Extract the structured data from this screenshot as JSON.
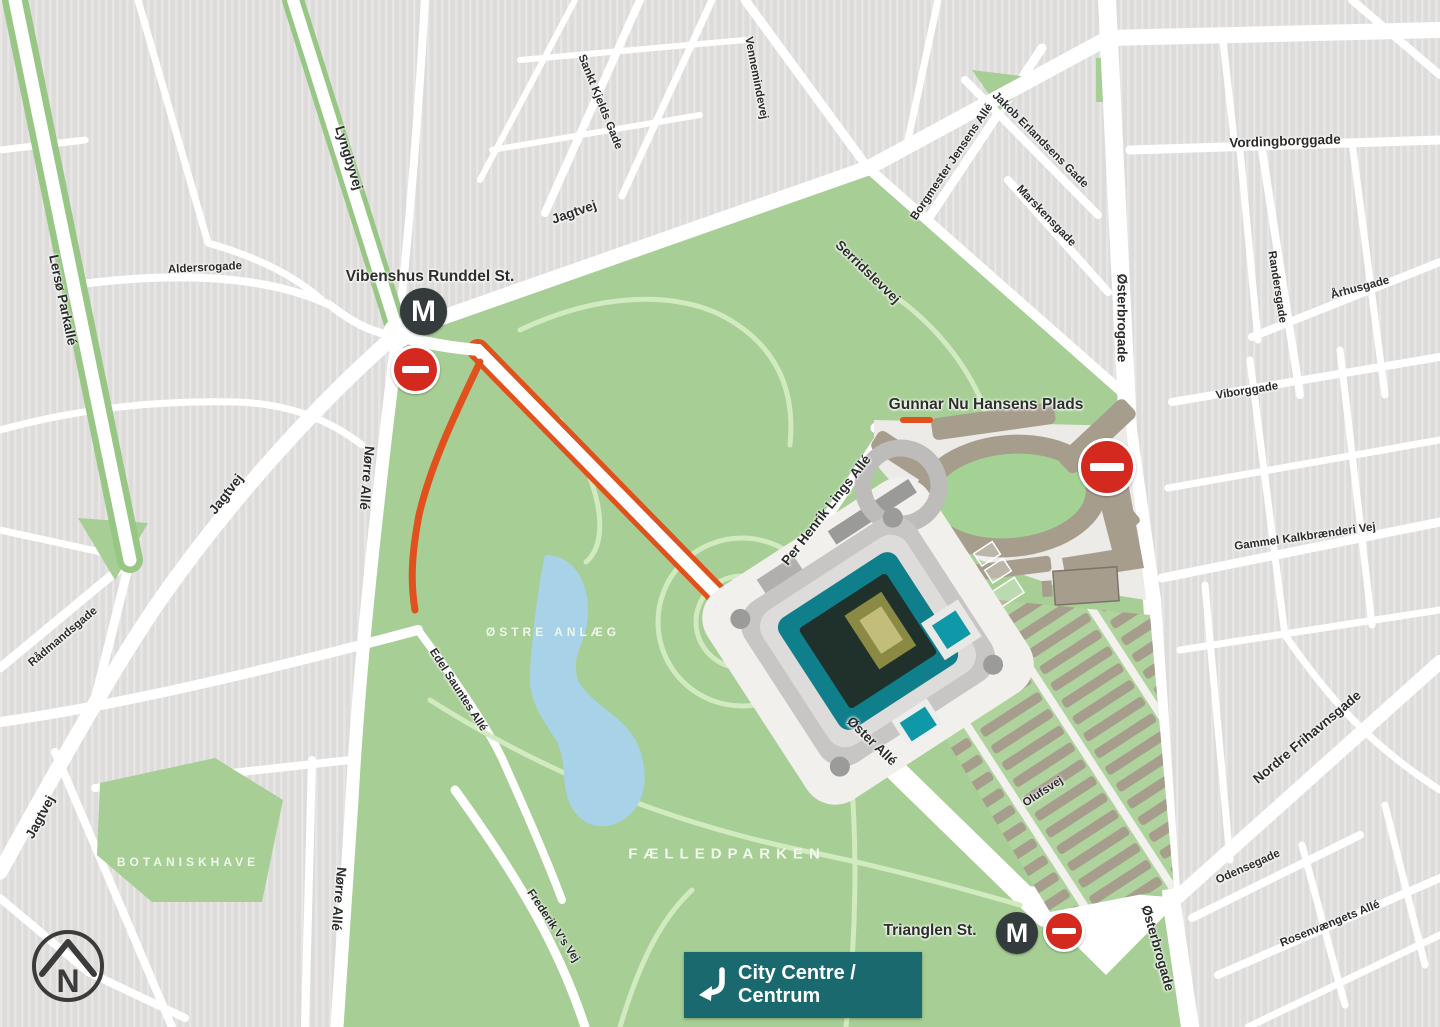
{
  "map": {
    "icons": {
      "metro_label": "M",
      "compass_label": "N",
      "no_entry_icon": "no-entry-sign",
      "metro_icon": "metro-station-circle",
      "compass_icon": "north-arrow-compass",
      "route_icon": "orange-route-highlight"
    },
    "city_centre": {
      "line1": "City Centre /",
      "line2": "Centrum",
      "arrow_icon": "bent-arrow-down-left"
    },
    "colors": {
      "park_green": "#a6ce95",
      "park_light": "#b2d6a0",
      "path_green": "#d2eabf",
      "block_gray": "#dddcda",
      "block_stripe": "#e7e6e4",
      "road_white": "#ffffff",
      "plaza_gray": "#ecebe8",
      "lake_blue": "#a8d2e8",
      "route_orange": "#e0511d",
      "metro_dark": "#333b3c",
      "no_entry_red": "#d4291f",
      "stand_tan": "#a69d8d",
      "teal_box": "#19696e",
      "stadium_teal": "#0f7f8b",
      "field_dark": "#20302a"
    },
    "labels": [
      {
        "id": "lerso-parkalle",
        "text": "Lersø Parkallé",
        "x": 63,
        "y": 300,
        "rot": 78,
        "cls": "street"
      },
      {
        "id": "lyngbyvej",
        "text": "Lyngbyvej",
        "x": 349,
        "y": 158,
        "rot": 73,
        "cls": "street"
      },
      {
        "id": "aldersrogade",
        "text": "Aldersrogade",
        "x": 205,
        "y": 268,
        "rot": -3,
        "cls": "street-sm"
      },
      {
        "id": "jagtvej-top",
        "text": "Jagtvej",
        "x": 574,
        "y": 212,
        "rot": -19,
        "cls": "street"
      },
      {
        "id": "sankt-kjelds-gade",
        "text": "Sankt Kjelds Gade",
        "x": 600,
        "y": 102,
        "rot": 68,
        "cls": "street-sm"
      },
      {
        "id": "vennemindevej",
        "text": "Vennemindevej",
        "x": 756,
        "y": 78,
        "rot": 79,
        "cls": "street-sm"
      },
      {
        "id": "serridslevvej",
        "text": "Serridslevvej",
        "x": 868,
        "y": 272,
        "rot": 44,
        "cls": "street"
      },
      {
        "id": "borgmester-jensens-alle",
        "text": "Borgmester Jensens Allé",
        "x": 952,
        "y": 162,
        "rot": -56,
        "cls": "street-sm"
      },
      {
        "id": "jakob-erlandsens-gade",
        "text": "Jakob Erlandsens Gade",
        "x": 1040,
        "y": 140,
        "rot": 45,
        "cls": "street-sm"
      },
      {
        "id": "marskensgade",
        "text": "Marskensgade",
        "x": 1046,
        "y": 216,
        "rot": 46,
        "cls": "street-sm"
      },
      {
        "id": "vordingborggade",
        "text": "Vordingborggade",
        "x": 1285,
        "y": 141,
        "rot": -2,
        "cls": "street"
      },
      {
        "id": "osterbrogade-top",
        "text": "Østerbrogade",
        "x": 1122,
        "y": 318,
        "rot": 90,
        "cls": "street"
      },
      {
        "id": "randersgade",
        "text": "Randersgade",
        "x": 1277,
        "y": 287,
        "rot": 81,
        "cls": "street-sm"
      },
      {
        "id": "aarhusgade",
        "text": "Århusgade",
        "x": 1360,
        "y": 288,
        "rot": -15,
        "cls": "street-sm"
      },
      {
        "id": "viborggade",
        "text": "Viborggade",
        "x": 1247,
        "y": 391,
        "rot": -9,
        "cls": "street-sm"
      },
      {
        "id": "gammel-kalkbraenderi-vej",
        "text": "Gammel Kalkbrænderi Vej",
        "x": 1305,
        "y": 537,
        "rot": -8,
        "cls": "street-sm"
      },
      {
        "id": "nordre-frihavnsgade",
        "text": "Nordre Frihavnsgade",
        "x": 1307,
        "y": 737,
        "rot": -40,
        "cls": "street"
      },
      {
        "id": "osterbrogade-bottom",
        "text": "Østerbrogade",
        "x": 1158,
        "y": 948,
        "rot": 74,
        "cls": "street"
      },
      {
        "id": "odensegade",
        "text": "Odensegade",
        "x": 1248,
        "y": 867,
        "rot": -24,
        "cls": "street-sm"
      },
      {
        "id": "rosenvaengets-alle",
        "text": "Rosenvængets Allé",
        "x": 1330,
        "y": 924,
        "rot": -22,
        "cls": "street-sm"
      },
      {
        "id": "gunnar-nu-hansens-plads",
        "text": "Gunnar Nu Hansens Plads",
        "x": 986,
        "y": 405,
        "rot": 0,
        "cls": "station"
      },
      {
        "id": "per-henrik-lings-alle",
        "text": "Per Henrik Lings Allé",
        "x": 826,
        "y": 510,
        "rot": -52,
        "cls": "street"
      },
      {
        "id": "oster-alle",
        "text": "Øster Allé",
        "x": 872,
        "y": 741,
        "rot": 44,
        "cls": "street"
      },
      {
        "id": "olufsvej",
        "text": "Olufsvej",
        "x": 1043,
        "y": 792,
        "rot": -33,
        "cls": "street-sm"
      },
      {
        "id": "norre-alle-upper",
        "text": "Nørre Allé",
        "x": 367,
        "y": 478,
        "rot": 95,
        "cls": "street"
      },
      {
        "id": "norre-alle-lower",
        "text": "Nørre Allé",
        "x": 339,
        "y": 899,
        "rot": 95,
        "cls": "street"
      },
      {
        "id": "jagtvej-left",
        "text": "Jagtvej",
        "x": 226,
        "y": 494,
        "rot": -52,
        "cls": "street"
      },
      {
        "id": "jagtvej-bottom-left",
        "text": "Jagtvej",
        "x": 40,
        "y": 817,
        "rot": -62,
        "cls": "street"
      },
      {
        "id": "raadmandsgade",
        "text": "Rådmandsgade",
        "x": 63,
        "y": 637,
        "rot": -40,
        "cls": "street-sm"
      },
      {
        "id": "edel-sauntes-alle",
        "text": "Edel Sauntes Allé",
        "x": 458,
        "y": 690,
        "rot": 57,
        "cls": "street-sm"
      },
      {
        "id": "frederik-vs-vej",
        "text": "Frederik V's Vej",
        "x": 553,
        "y": 926,
        "rot": 56,
        "cls": "street-sm"
      },
      {
        "id": "trianglen-st",
        "text": "Trianglen St.",
        "x": 930,
        "y": 931,
        "rot": 0,
        "cls": "station"
      },
      {
        "id": "vibenshus-runddel-st",
        "text": "Vibenshus Runddel St.",
        "x": 430,
        "y": 277,
        "rot": 0,
        "cls": "station"
      },
      {
        "id": "ostre-anlaeg",
        "text": "ØSTRE ANLÆG",
        "x": 553,
        "y": 632,
        "rot": 0,
        "cls": "park-sm"
      },
      {
        "id": "faelledparken",
        "text": "FÆLLEDPARKEN",
        "x": 727,
        "y": 854,
        "rot": 0,
        "cls": "park"
      },
      {
        "id": "botaniskhave",
        "text": "BOTANISKHAVE",
        "x": 188,
        "y": 862,
        "rot": 0,
        "cls": "park-sm"
      }
    ]
  }
}
